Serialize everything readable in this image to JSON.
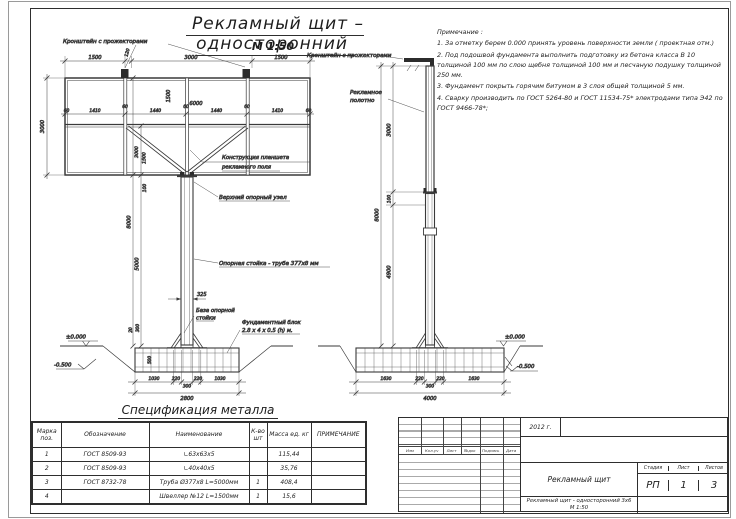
{
  "sheet": {
    "title": "Рекламный щит  –  односторонний",
    "scale": "М 1:50"
  },
  "notes": {
    "title": "Примечание :",
    "items": [
      "1. За отметку берем 0.000 принять уровень поверхности земли ( проектная отм.)",
      "2. Под подошвой фундамента выполнить подготовку из бетона класса В 10 толщиной 100 мм по слою щебня толщиной 100 мм и песчаную подушку толщиной 250 мм.",
      "3. Фундамент покрыть горячим битумом в 3 слоя общей толщиной 5 мм.",
      "4. Сварку производить по ГОСТ 5264-80 и ГОСТ 11534-75* электродами типа Э42 по ГОСТ 9466-78*;"
    ]
  },
  "front_view": {
    "labels": {
      "bracket": "Кронштейн с прожекторами",
      "panel1": "Конструкция планшета",
      "panel2": "рекламного поля",
      "top_node": "Верхний опорный узел",
      "pole": "Опорная стойка  -  труба 377х8 мм",
      "base1": "База опорной",
      "base2": "стойки",
      "foundation1": "Фундаментный блок",
      "foundation2": "2.8 х 4 х 0.5 (h) м."
    },
    "dims": {
      "top": [
        "1500",
        "120",
        "3000",
        "1500"
      ],
      "cells": [
        "60",
        "1410",
        "60",
        "1440",
        "60",
        "1440",
        "60",
        "1410",
        "60"
      ],
      "panel_height": "3000",
      "bracket_h": "1500",
      "width": "6000",
      "d1": "3000",
      "d2": "1500",
      "h_total": "8000",
      "h_pole": "5000",
      "node": "100",
      "dia": "325",
      "gap": "20",
      "base_h": "300",
      "depth": "500",
      "bottom": [
        "1030",
        "220",
        "300",
        "220",
        "1030"
      ],
      "bottom_total": "2800",
      "level_zero": "±0.000",
      "level_low": "-0.500"
    }
  },
  "side_view": {
    "labels": {
      "bracket": "Кронштейн с прожекторами",
      "canvas1": "Рекламное",
      "canvas2": "полотно"
    },
    "dims": {
      "panel_h": "3000",
      "node": "100",
      "h_total": "8000",
      "h_clear": "4900",
      "bottom": [
        "1630",
        "220",
        "300",
        "220",
        "1630"
      ],
      "bottom_total": "4000",
      "level_zero": "±0.000",
      "level_low": "-0.500"
    }
  },
  "spec_table": {
    "title": "Спецификация металла",
    "headers": [
      "Марка поз.",
      "Обозначение",
      "Наименование",
      "К-во шт",
      "Масса ед. кг",
      "ПРИМЕЧАНИЕ"
    ],
    "rows": [
      {
        "mark": "1",
        "designation": "ГОСТ  8509-93",
        "name": "∟63х63х5",
        "qty": "",
        "mass": "115,44",
        "note": ""
      },
      {
        "mark": "2",
        "designation": "ГОСТ  8509-93",
        "name": "∟40х40х5",
        "qty": "",
        "mass": "35,76",
        "note": ""
      },
      {
        "mark": "3",
        "designation": "ГОСТ  8732-78",
        "name": "Труба  Ø377х8  L=5000мм",
        "qty": "1",
        "mass": "408,4",
        "note": ""
      },
      {
        "mark": "4",
        "designation": "",
        "name": "Швеллер  №12  L=1500мм",
        "qty": "1",
        "mass": "15,6",
        "note": ""
      }
    ]
  },
  "title_block": {
    "year": "2012  г.",
    "stamp_headers": [
      "Изм",
      "Кол.уч",
      "Лист",
      "№док",
      "Подпись",
      "Дата"
    ],
    "project": "Рекламный щит",
    "doc_name": "Рекламный щит - односторонний 3х6",
    "doc_scale": "М 1:50",
    "stage_label": "Стадия",
    "sheet_label": "Лист",
    "sheets_label": "Листов",
    "stage": "РП",
    "sheet": "1",
    "sheets": "3"
  }
}
